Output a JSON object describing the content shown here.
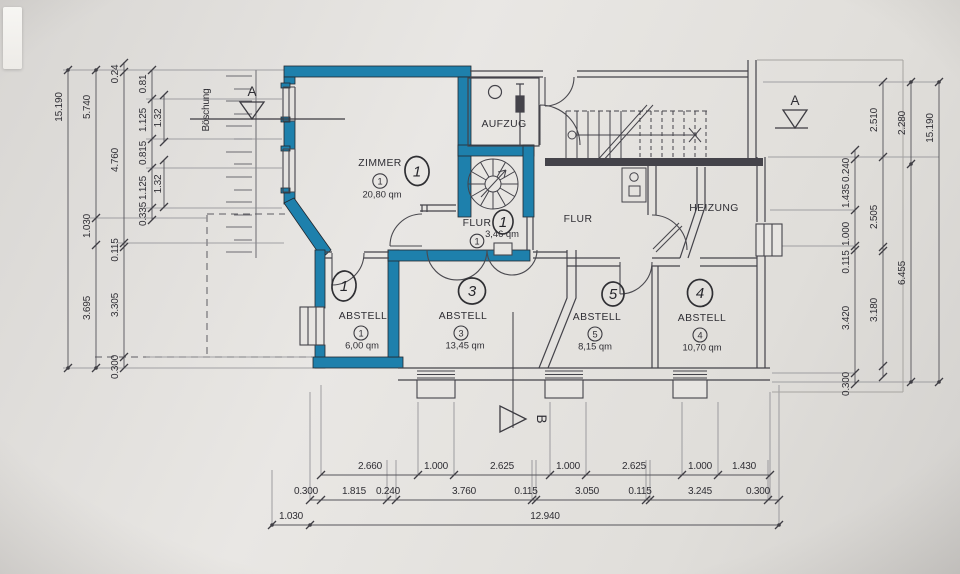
{
  "rooms": {
    "zimmer": {
      "label": "ZIMMER",
      "number": "1",
      "area": "20,80 qm",
      "marker": "1"
    },
    "aufzug": {
      "label": "AUFZUG"
    },
    "flur_klein": {
      "label": "FLUR",
      "number": "1",
      "area": "3,46 qm",
      "marker": "1"
    },
    "flur": {
      "label": "FLUR"
    },
    "heizung": {
      "label": "HEIZUNG"
    },
    "abstell_1": {
      "label": "ABSTELL",
      "number": "1",
      "area": "6,00 qm",
      "marker": "1"
    },
    "abstell_3": {
      "label": "ABSTELL",
      "number": "3",
      "area": "13,45 qm",
      "marker": "3"
    },
    "abstell_5": {
      "label": "ABSTELL",
      "number": "5",
      "area": "8,15 qm",
      "marker": "5"
    },
    "abstell_4": {
      "label": "ABSTELL",
      "number": "4",
      "area": "10,70 qm",
      "marker": "4"
    }
  },
  "site": {
    "boeschung": "Böschung"
  },
  "sections": {
    "a_left": "A",
    "a_right": "A",
    "b": "B"
  },
  "dims": {
    "left": {
      "c1": [
        "15.190"
      ],
      "c2": [
        "5.740",
        "1.030",
        "3.695"
      ],
      "c3": [
        "0.24",
        "4.760",
        "0.115",
        "3.305",
        "0.300"
      ],
      "c4": [
        "0.81",
        "1.125",
        "0.815",
        "1.125",
        "0.335"
      ],
      "c5": [
        "1.32",
        "1.32"
      ]
    },
    "right": {
      "c1": [
        "0.240",
        "1.435",
        "1.000",
        "0.115",
        "3.420",
        "0.300"
      ],
      "c2": [
        "2.510",
        "2.505",
        "3.180"
      ],
      "c3": [
        "2.280",
        "6.455"
      ],
      "c4": [
        "15.190"
      ]
    },
    "bottom": {
      "c1": [
        "2.660",
        "1.000",
        "2.625",
        "1.000",
        "2.625",
        "1.000",
        "1.430"
      ],
      "c2": [
        "0.300",
        "1.815",
        "0.240",
        "3.760",
        "0.115",
        "3.050",
        "0.115",
        "3.245",
        "0.300"
      ],
      "c3": [
        "1.030",
        "12.940"
      ]
    }
  },
  "colors": {
    "highlight": "#1e80ac",
    "ink": "#44434a",
    "paper": "#e2e0dd"
  }
}
